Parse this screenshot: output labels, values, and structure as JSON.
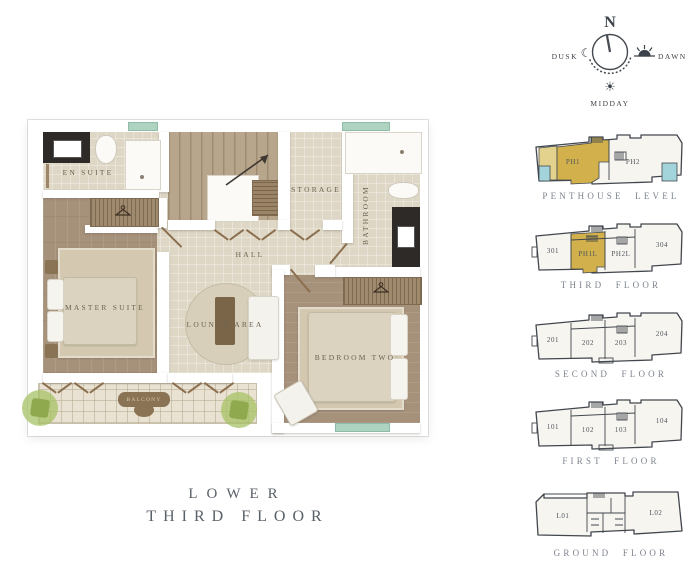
{
  "title": {
    "line1": "LOWER",
    "line2": "THIRD FLOOR"
  },
  "compass": {
    "north": "N",
    "dusk": "DUSK",
    "dawn": "DAWN",
    "midday": "MIDDAY"
  },
  "floorplan": {
    "rooms": {
      "en_suite": "EN SUITE",
      "storage": "STORAGE",
      "bathroom": "BATHROOM",
      "hall": "HALL",
      "master_suite": "MASTER SUITE",
      "lounge_area": "LOUNGE AREA",
      "bedroom_two": "BEDROOM TWO",
      "balcony": "BALCONY"
    }
  },
  "key_plans": [
    {
      "name": "PENTHOUSE LEVEL",
      "units": [
        "PH1",
        "PH2"
      ],
      "highlighted_unit": "PH1"
    },
    {
      "name": "THIRD FLOOR",
      "units": [
        "301",
        "PH1L",
        "PH2L",
        "304"
      ],
      "highlighted_unit": "PH1L"
    },
    {
      "name": "SECOND FLOOR",
      "units": [
        "201",
        "202",
        "203",
        "204"
      ],
      "highlighted_unit": null
    },
    {
      "name": "FIRST FLOOR",
      "units": [
        "101",
        "102",
        "103",
        "104"
      ],
      "highlighted_unit": null
    },
    {
      "name": "GROUND FLOOR",
      "units": [
        "L01",
        "L02"
      ],
      "highlighted_unit": null
    }
  ],
  "colors": {
    "highlight_gold": "#d2b14c",
    "highlight_gold_pale": "#e3d28e",
    "balcony_cyan": "#a4d4db",
    "window_teal": "#aed3c0",
    "plan_ink": "#42474e",
    "floor_label_grey": "#7d838d",
    "room_label_brown": "#6d6150",
    "title_grey": "#5a6069"
  }
}
